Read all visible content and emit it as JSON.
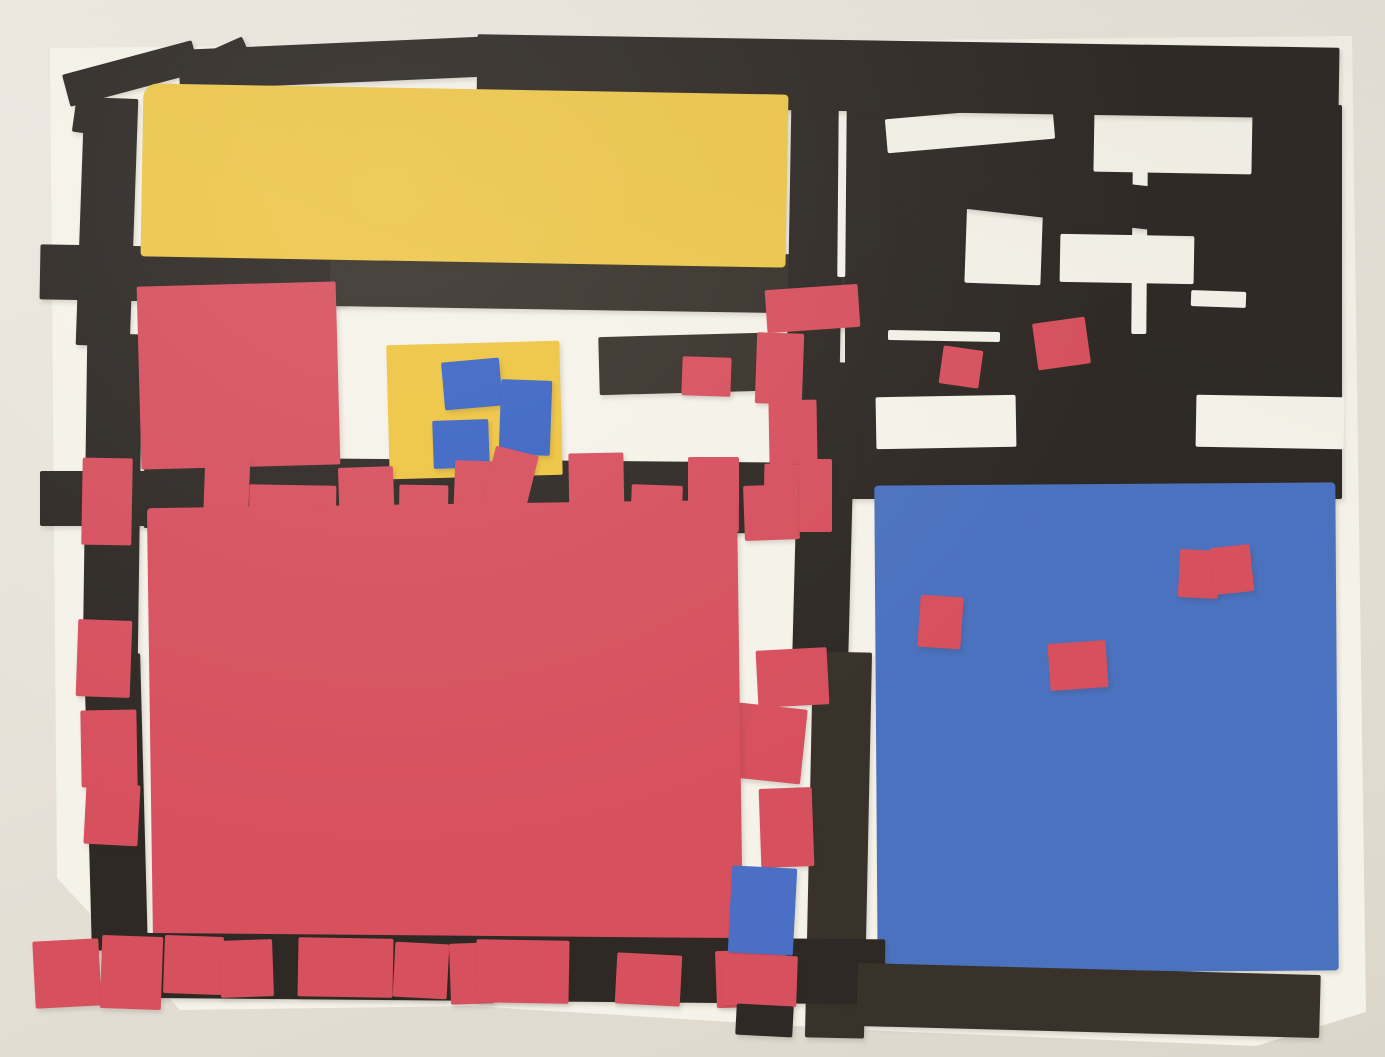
{
  "artwork": {
    "kind": "photograph-of-paper-collage",
    "style": "Mondrian-inspired cut construction paper on white sheet",
    "palette": {
      "black": "#2e2925",
      "black2": "#38322b",
      "paper": "#f5f2e9",
      "yellow": "#ecc64a",
      "yellow2": "#eec441",
      "red": "#d7505e",
      "blue": "#4b72bf",
      "blue2": "#3c65c3",
      "blue3": "#4b6fc5"
    },
    "shapes": [
      {
        "n": "white-paper-sheet",
        "c": "paper",
        "x": 0,
        "y": 0,
        "w": 1385,
        "h": 1057,
        "r": 0,
        "sh": 0,
        "clip": "polygon(50px 48px, 1352px 36px, 1366px 1012px, 1256px 1046px, 862px 1030px, 470px 1006px, 180px 1010px, 57px 878px)"
      },
      {
        "n": "black-strip-top-left-diagonal",
        "x": 64,
        "y": 57,
        "w": 134,
        "h": 33,
        "r": -15
      },
      {
        "n": "black-strip-fold-corner",
        "x": 183,
        "y": 49,
        "w": 70,
        "h": 40,
        "r": -24
      },
      {
        "n": "black-strip-top-left",
        "x": 179,
        "y": 43,
        "w": 318,
        "h": 40,
        "r": -2.5
      },
      {
        "n": "black-strip-left-vertical-upper",
        "x": 80,
        "y": 98,
        "w": 54,
        "h": 248,
        "r": 2
      },
      {
        "n": "black-strip-left-notch",
        "x": 74,
        "y": 101,
        "w": 34,
        "h": 33,
        "r": 8
      },
      {
        "n": "black-strip-left-vertical-middle",
        "x": 85,
        "y": 334,
        "w": 55,
        "h": 332,
        "r": 0.8
      },
      {
        "n": "black-strip-left-vertical-lower",
        "x": 88,
        "y": 654,
        "w": 56,
        "h": 296,
        "r": -1.5
      },
      {
        "n": "black-strip-left-horizontal",
        "x": 40,
        "y": 247,
        "w": 306,
        "h": 55,
        "r": 1
      },
      {
        "n": "black-band-below-yellow",
        "c": "black2",
        "x": 330,
        "y": 252,
        "w": 636,
        "h": 59,
        "r": 0.9
      },
      {
        "n": "black-strip-mid-left",
        "x": 40,
        "y": 471,
        "w": 126,
        "h": 55,
        "r": 0
      },
      {
        "n": "black-strip-red-row",
        "x": 144,
        "y": 460,
        "w": 702,
        "h": 71,
        "r": 0.5
      },
      {
        "n": "black-strip-center-vertical-upper",
        "x": 789,
        "y": 105,
        "w": 53,
        "h": 270,
        "r": 1
      },
      {
        "n": "black-panel-top-right",
        "x": 845,
        "y": 105,
        "w": 497,
        "h": 394,
        "r": 0
      },
      {
        "n": "white-gap-1",
        "c": "paper",
        "x": 886,
        "y": 112,
        "w": 168,
        "h": 34,
        "r": -5,
        "sh": 0
      },
      {
        "n": "white-gap-2",
        "c": "paper",
        "x": 1094,
        "y": 107,
        "w": 158,
        "h": 66,
        "r": 1,
        "sh": 0
      },
      {
        "n": "white-gap-3",
        "c": "paper",
        "x": 966,
        "y": 191,
        "w": 76,
        "h": 93,
        "r": 2,
        "sh": 0
      },
      {
        "n": "white-gap-4",
        "c": "paper",
        "x": 1060,
        "y": 235,
        "w": 134,
        "h": 48,
        "r": 1,
        "sh": 0
      },
      {
        "n": "white-gap-5",
        "c": "paper",
        "x": 1196,
        "y": 396,
        "w": 148,
        "h": 52,
        "r": 1,
        "sh": 0
      },
      {
        "n": "white-gap-6",
        "c": "paper",
        "x": 876,
        "y": 396,
        "w": 140,
        "h": 52,
        "r": -1,
        "sh": 0
      },
      {
        "n": "white-sliver-vertical",
        "c": "paper",
        "x": 1132,
        "y": 171,
        "w": 15,
        "h": 163,
        "r": 0.5,
        "sh": 0
      },
      {
        "n": "white-sliver-horizontal",
        "c": "paper",
        "x": 1191,
        "y": 291,
        "w": 55,
        "h": 16,
        "r": 2,
        "sh": 0
      },
      {
        "n": "white-sliver-top",
        "c": "paper",
        "x": 888,
        "y": 331,
        "w": 112,
        "h": 10,
        "r": 1,
        "sh": 0
      },
      {
        "n": "white-sliver-left",
        "c": "paper",
        "x": 838,
        "y": 107,
        "w": 8,
        "h": 170,
        "r": 0.5,
        "sh": 0
      },
      {
        "n": "black-strip-diagonal-right",
        "x": 897,
        "y": 175,
        "w": 302,
        "h": 43,
        "r": 6.5
      },
      {
        "n": "black-band-top",
        "x": 477,
        "y": 41,
        "w": 862,
        "h": 71,
        "r": 0.9
      },
      {
        "n": "red-chip-top-right-1",
        "c": "red",
        "x": 941,
        "y": 348,
        "w": 40,
        "h": 38,
        "r": 8
      },
      {
        "n": "red-chip-top-right-2",
        "c": "red",
        "x": 1035,
        "y": 320,
        "w": 53,
        "h": 47,
        "r": -8
      },
      {
        "n": "yellow-rectangle-large",
        "c": "yellow",
        "x": 142,
        "y": 89,
        "w": 645,
        "h": 173,
        "r": 1,
        "br": "14px 4px 4px 4px"
      },
      {
        "n": "red-square-upper-left",
        "c": "red",
        "x": 139,
        "y": 284,
        "w": 199,
        "h": 183,
        "r": -1.5
      },
      {
        "n": "yellow-rectangle-small",
        "c": "yellow2",
        "x": 388,
        "y": 343,
        "w": 173,
        "h": 134,
        "r": -1.5
      },
      {
        "n": "blue-chip-mini-1",
        "c": "blue2",
        "x": 443,
        "y": 360,
        "w": 58,
        "h": 48,
        "r": -5
      },
      {
        "n": "blue-chip-mini-2",
        "c": "blue2",
        "x": 500,
        "y": 380,
        "w": 51,
        "h": 75,
        "r": 2
      },
      {
        "n": "blue-chip-mini-3",
        "c": "blue2",
        "x": 433,
        "y": 420,
        "w": 56,
        "h": 48,
        "r": -2
      },
      {
        "n": "black-bar-center",
        "c": "black2",
        "x": 599,
        "y": 335,
        "w": 163,
        "h": 58,
        "r": -1.5
      },
      {
        "n": "red-chip-center-left",
        "c": "red",
        "x": 682,
        "y": 357,
        "w": 49,
        "h": 39,
        "r": 2
      },
      {
        "n": "black-strip-center-vertical-middle",
        "x": 796,
        "y": 362,
        "w": 56,
        "h": 304,
        "r": 1.5
      },
      {
        "n": "black-strip-center-vertical-lower",
        "c": "black2",
        "x": 809,
        "y": 652,
        "w": 59,
        "h": 386,
        "r": 1.2
      },
      {
        "n": "red-chip-column-1",
        "c": "red",
        "x": 766,
        "y": 287,
        "w": 93,
        "h": 43,
        "r": -4
      },
      {
        "n": "red-chip-column-2",
        "c": "red",
        "x": 756,
        "y": 333,
        "w": 47,
        "h": 71,
        "r": 2
      },
      {
        "n": "red-chip-column-3",
        "c": "red",
        "x": 769,
        "y": 400,
        "w": 48,
        "h": 64,
        "r": -1
      },
      {
        "n": "red-chip-column-4",
        "c": "red",
        "x": 764,
        "y": 464,
        "w": 48,
        "h": 49,
        "r": 1
      },
      {
        "n": "red-chip-column-5",
        "c": "red",
        "x": 757,
        "y": 649,
        "w": 71,
        "h": 57,
        "r": -3
      },
      {
        "n": "red-chip-column-6",
        "c": "red",
        "x": 735,
        "y": 706,
        "w": 69,
        "h": 75,
        "r": 6
      },
      {
        "n": "red-chip-column-7",
        "c": "red",
        "x": 760,
        "y": 788,
        "w": 53,
        "h": 79,
        "r": -2
      },
      {
        "n": "red-chip-row-1",
        "c": "red",
        "x": 204,
        "y": 459,
        "w": 45,
        "h": 71,
        "r": 2
      },
      {
        "n": "red-chip-row-2",
        "c": "red",
        "x": 249,
        "y": 485,
        "w": 87,
        "h": 49,
        "r": 1
      },
      {
        "n": "red-chip-row-3",
        "c": "red",
        "x": 339,
        "y": 467,
        "w": 55,
        "h": 63,
        "r": -2
      },
      {
        "n": "red-chip-row-4",
        "c": "red",
        "x": 399,
        "y": 485,
        "w": 49,
        "h": 48,
        "r": 1
      },
      {
        "n": "red-chip-row-5",
        "c": "red",
        "x": 454,
        "y": 461,
        "w": 53,
        "h": 71,
        "r": 2
      },
      {
        "n": "red-chip-row-6-tilted",
        "c": "red",
        "x": 488,
        "y": 450,
        "w": 44,
        "h": 62,
        "r": 14
      },
      {
        "n": "red-chip-row-7",
        "c": "red",
        "x": 569,
        "y": 453,
        "w": 55,
        "h": 77,
        "r": -1
      },
      {
        "n": "red-chip-row-8",
        "c": "red",
        "x": 631,
        "y": 485,
        "w": 51,
        "h": 48,
        "r": 2
      },
      {
        "n": "red-chip-row-9",
        "c": "red",
        "x": 688,
        "y": 457,
        "w": 51,
        "h": 75,
        "r": 0
      },
      {
        "n": "red-chip-row-10",
        "c": "red",
        "x": 744,
        "y": 485,
        "w": 55,
        "h": 55,
        "r": -2
      },
      {
        "n": "red-chip-row-11",
        "c": "red",
        "x": 799,
        "y": 459,
        "w": 33,
        "h": 73,
        "r": 0
      },
      {
        "n": "red-square-large",
        "c": "red",
        "x": 150,
        "y": 504,
        "w": 590,
        "h": 441,
        "r": -0.8,
        "br": "4px"
      },
      {
        "n": "red-chip-left-1",
        "c": "red",
        "x": 82,
        "y": 458,
        "w": 50,
        "h": 87,
        "r": 1
      },
      {
        "n": "red-chip-left-2",
        "c": "red",
        "x": 77,
        "y": 620,
        "w": 54,
        "h": 77,
        "r": 2
      },
      {
        "n": "red-chip-left-3",
        "c": "red",
        "x": 81,
        "y": 710,
        "w": 56,
        "h": 77,
        "r": -1
      },
      {
        "n": "red-chip-left-4",
        "c": "red",
        "x": 85,
        "y": 784,
        "w": 54,
        "h": 61,
        "r": 3
      },
      {
        "n": "blue-square-large",
        "c": "blue",
        "x": 876,
        "y": 484,
        "w": 461,
        "h": 488,
        "r": -0.4,
        "br": "4px"
      },
      {
        "n": "red-chip-on-blue-1",
        "c": "red",
        "x": 919,
        "y": 596,
        "w": 43,
        "h": 52,
        "r": 4
      },
      {
        "n": "red-chip-on-blue-2",
        "c": "red",
        "x": 1049,
        "y": 642,
        "w": 58,
        "h": 47,
        "r": -4
      },
      {
        "n": "red-chip-on-blue-3",
        "c": "red",
        "x": 1179,
        "y": 550,
        "w": 40,
        "h": 48,
        "r": 3
      },
      {
        "n": "red-chip-on-blue-4",
        "c": "red",
        "x": 1212,
        "y": 546,
        "w": 40,
        "h": 47,
        "r": -6
      },
      {
        "n": "black-strip-bottom",
        "x": 111,
        "y": 936,
        "w": 774,
        "h": 65,
        "r": 0.5
      },
      {
        "n": "red-chip-bottom-1",
        "c": "red",
        "x": 34,
        "y": 940,
        "w": 66,
        "h": 67,
        "r": -3
      },
      {
        "n": "red-chip-bottom-2",
        "c": "red",
        "x": 101,
        "y": 936,
        "w": 61,
        "h": 73,
        "r": 2
      },
      {
        "n": "red-chip-bottom-3",
        "c": "red",
        "x": 164,
        "y": 936,
        "w": 59,
        "h": 58,
        "r": 2
      },
      {
        "n": "red-chip-bottom-4",
        "c": "red",
        "x": 220,
        "y": 940,
        "w": 53,
        "h": 57,
        "r": -2
      },
      {
        "n": "red-chip-bottom-5",
        "c": "red",
        "x": 298,
        "y": 938,
        "w": 95,
        "h": 59,
        "r": 1
      },
      {
        "n": "red-chip-bottom-6",
        "c": "red",
        "x": 394,
        "y": 943,
        "w": 54,
        "h": 55,
        "r": 3
      },
      {
        "n": "red-chip-bottom-7",
        "c": "red",
        "x": 450,
        "y": 943,
        "w": 43,
        "h": 61,
        "r": -2
      },
      {
        "n": "red-chip-bottom-8",
        "c": "red",
        "x": 476,
        "y": 940,
        "w": 93,
        "h": 63,
        "r": 1
      },
      {
        "n": "red-chip-bottom-9",
        "c": "red",
        "x": 616,
        "y": 954,
        "w": 65,
        "h": 51,
        "r": 3
      },
      {
        "n": "red-chip-bottom-10",
        "c": "red",
        "x": 716,
        "y": 950,
        "w": 71,
        "h": 57,
        "r": -2
      },
      {
        "n": "blue-square-small-bottom",
        "c": "blue3",
        "x": 730,
        "y": 867,
        "w": 65,
        "h": 87,
        "r": 3
      },
      {
        "n": "red-chip-column-8",
        "c": "red",
        "x": 722,
        "y": 955,
        "w": 75,
        "h": 51,
        "r": 2
      },
      {
        "n": "black-tab-bottom",
        "x": 736,
        "y": 1005,
        "w": 57,
        "h": 31,
        "r": 3
      },
      {
        "n": "black-strip-bottom-right",
        "c": "black2",
        "x": 857,
        "y": 969,
        "w": 463,
        "h": 63,
        "r": 1.5
      }
    ]
  }
}
